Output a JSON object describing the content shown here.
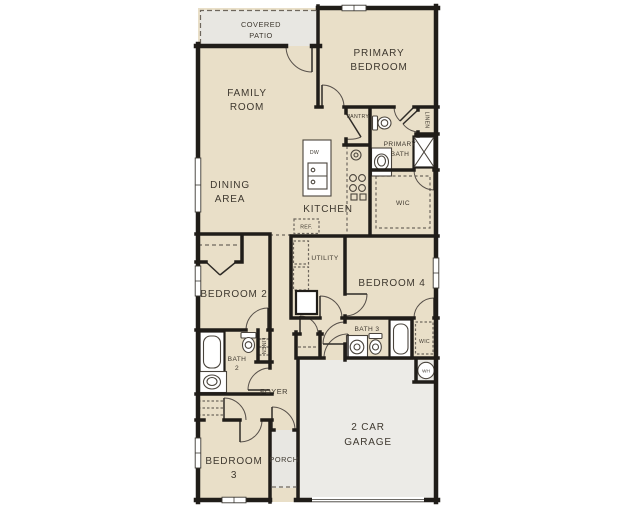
{
  "plan_type": "single-story house floor plan",
  "colors": {
    "background": "#ffffff",
    "floor": "#e9dfc8",
    "outdoor": "#e8e7e2",
    "garage_floor": "#ecebe7",
    "wall": "#201d19",
    "text": "#3e382f"
  },
  "rooms": {
    "covered_patio": {
      "lines": [
        "COVERED",
        "PATIO"
      ]
    },
    "primary_bedroom": {
      "lines": [
        "PRIMARY",
        "BEDROOM"
      ]
    },
    "family_room": {
      "lines": [
        "FAMILY",
        "ROOM"
      ]
    },
    "dining_area": {
      "lines": [
        "DINING",
        "AREA"
      ]
    },
    "kitchen": {
      "lines": [
        "KITCHEN"
      ]
    },
    "pantry": {
      "lines": [
        "PANTRY"
      ]
    },
    "primary_bath": {
      "lines": [
        "PRIMARY",
        "BATH"
      ]
    },
    "linen_primary": {
      "lines": [
        "LINEN"
      ]
    },
    "wic_primary": {
      "lines": [
        "WIC"
      ]
    },
    "utility": {
      "lines": [
        "UTILITY"
      ]
    },
    "bedroom_2": {
      "lines": [
        "BEDROOM 2"
      ]
    },
    "bedroom_4": {
      "lines": [
        "BEDROOM 4"
      ]
    },
    "bath_3": {
      "lines": [
        "BATH 3"
      ]
    },
    "wic_bedroom_4": {
      "lines": [
        "WIC"
      ]
    },
    "bath_2": {
      "lines": [
        "BATH",
        "2"
      ]
    },
    "linen_hall": {
      "lines": [
        "LINEN"
      ]
    },
    "foyer": {
      "lines": [
        "FOYER"
      ]
    },
    "bedroom_3": {
      "lines": [
        "BEDROOM",
        "3"
      ]
    },
    "porch": {
      "lines": [
        "PORCH"
      ]
    },
    "garage": {
      "lines": [
        "2 CAR",
        "GARAGE"
      ]
    }
  },
  "appliances": {
    "dishwasher": "DW",
    "refrigerator": "REF.",
    "water_heater": "WH"
  }
}
